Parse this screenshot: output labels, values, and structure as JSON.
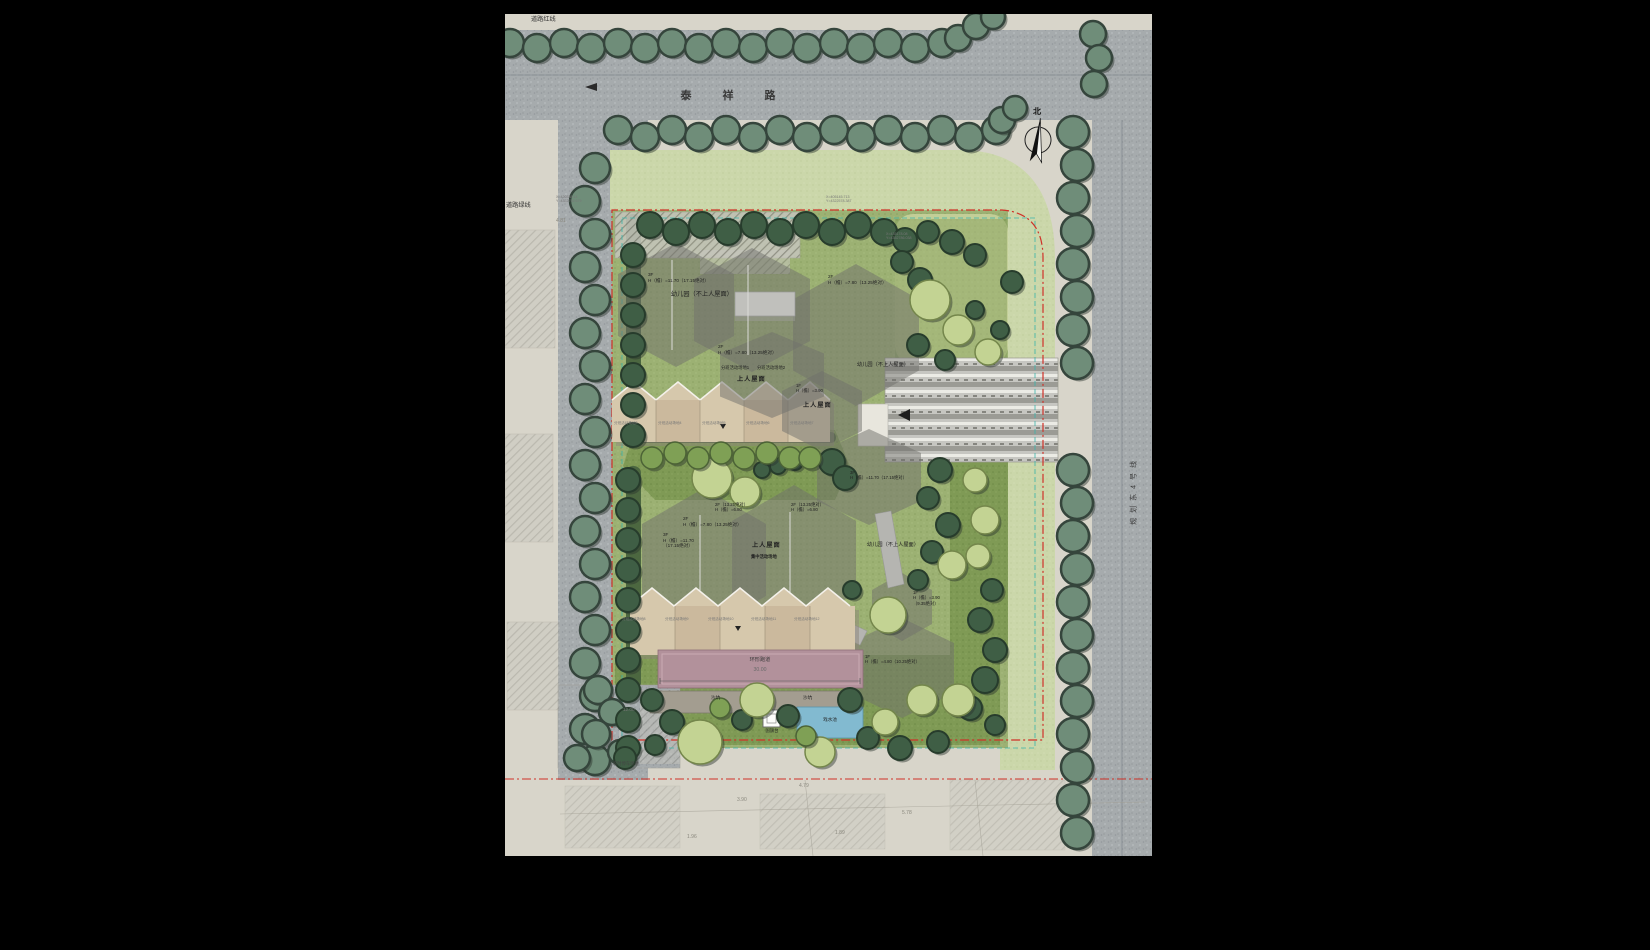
{
  "plan": {
    "roads": {
      "top_road": "泰 祥 路",
      "right_road": "规划东4号线",
      "red_line_label": "道路红线",
      "green_line_label": "道路绿线",
      "north_label": "北"
    },
    "buildings": {
      "b1_floor": "3F",
      "b1_height": "H（檐）=11.70（17.15绝对）",
      "b1_name": "幼儿园（不上人屋面）",
      "b2_floor": "2F",
      "b2_height": "H（檐）=7.80（13.25绝对）",
      "b2_name": "幼儿园（不上人屋面）",
      "b3_floor": "2F",
      "b3_height": "H（檐）=7.80（13.25绝对）",
      "b3_area1": "分班活动场地1",
      "b3_area2": "分班活动场地2",
      "b3_roof": "上人屋面",
      "b4_floor": "1F",
      "b4_height": "H（檐）=3.90",
      "b4_roof": "上人屋面",
      "b5_floor": "3F",
      "b5_height": "H（檐）=11.70（17.15绝对）",
      "b6_floor_2f": "2F",
      "b6_height_2f": "H（檐）=7.80（13.25绝对）",
      "b6_floor_3f": "3F",
      "b6_height_3f": "H（檐）=11.70",
      "b6_height_3f_abs": "（17.15绝对）",
      "b6_roof": "上人屋面",
      "b6_roof_sub": "集中活动场地",
      "b6_name": "幼儿园（不上人屋面）",
      "callout_a_line1": "2F（13.25绝对）",
      "callout_a_line2": "H（檐）=6.80",
      "callout_b_line1": "2F（13.25绝对）",
      "callout_b_line2": "H（檐）=6.80",
      "b7_floor": "1F",
      "b7_height": "H（檐）=3.90",
      "b7_height_abs": "（9.35绝对）",
      "b8_floor": "1F",
      "b8_height": "H（檐）=4.80（10.25绝对）"
    },
    "site_features": {
      "class_area_row1": [
        "分班活动场地3",
        "分班活动场地4",
        "分班活动场地5",
        "分班活动场地6",
        "分班活动场地7"
      ],
      "class_area_row2": [
        "分班活动场地8",
        "分班活动场地9",
        "分班活动场地10",
        "分班活动场地11",
        "分班活动场地12"
      ],
      "track_label": "环形跑道",
      "track_length": "30.00",
      "sand_label": "沙坑",
      "pool_label": "戏水池",
      "flag_label": "国旗台",
      "parking_label": "临时停车场地",
      "parking_dim": "12.00"
    },
    "annotations": {
      "coords": [
        {
          "x": "X=420338.14",
          "y": "Y=4352792.679"
        },
        {
          "x": "X=405145.713",
          "y": "Y=4322578.387"
        },
        {
          "x": "X=435178.08",
          "y": "Y=4352786.038"
        }
      ],
      "spot_elevations": [
        "4.81",
        "3.90",
        "4.79",
        "5.78",
        "1.89",
        "1.96"
      ]
    },
    "colors": {
      "boundary_red": "#cf3128",
      "setback_teal": "#3ab5ab",
      "track_pink": "#b2919b",
      "pool_blue": "#82bad0"
    }
  }
}
